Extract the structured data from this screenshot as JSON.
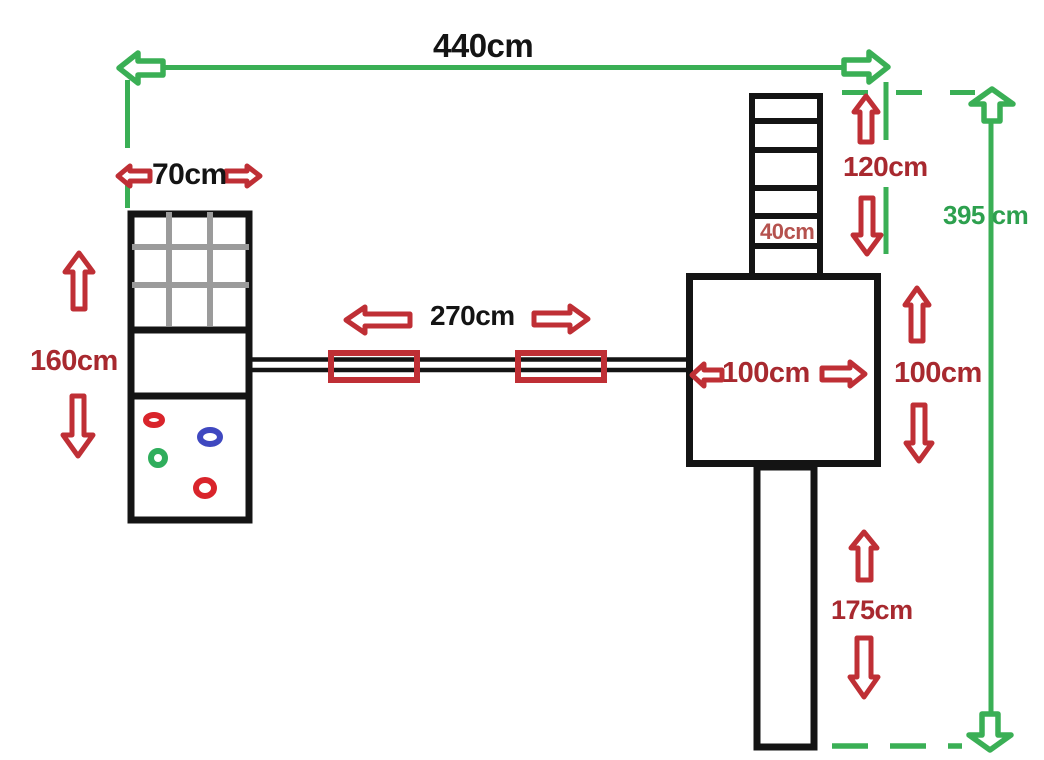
{
  "labels": {
    "total_width": "440cm",
    "tower_width": "70cm",
    "tower_height": "160cm",
    "bridge_length": "270cm",
    "platform_width": "100cm",
    "platform_height": "100cm",
    "ladder_height": "120cm",
    "ladder_rung": "40cm",
    "slide_height": "175cm",
    "total_height": "395 cm"
  },
  "colors": {
    "dimension_green": "#3aaf55",
    "dimension_red": "#bf2f35",
    "text_black": "#141414",
    "text_red": "#a8292f",
    "text_soft_red": "#b5524e",
    "text_green": "#2da04e",
    "structure_black": "#141414",
    "grid_gray": "#9b9b9b",
    "ring_red": "#d9242b",
    "ring_blue": "#3f48c0",
    "ring_green": "#2fae5c"
  }
}
